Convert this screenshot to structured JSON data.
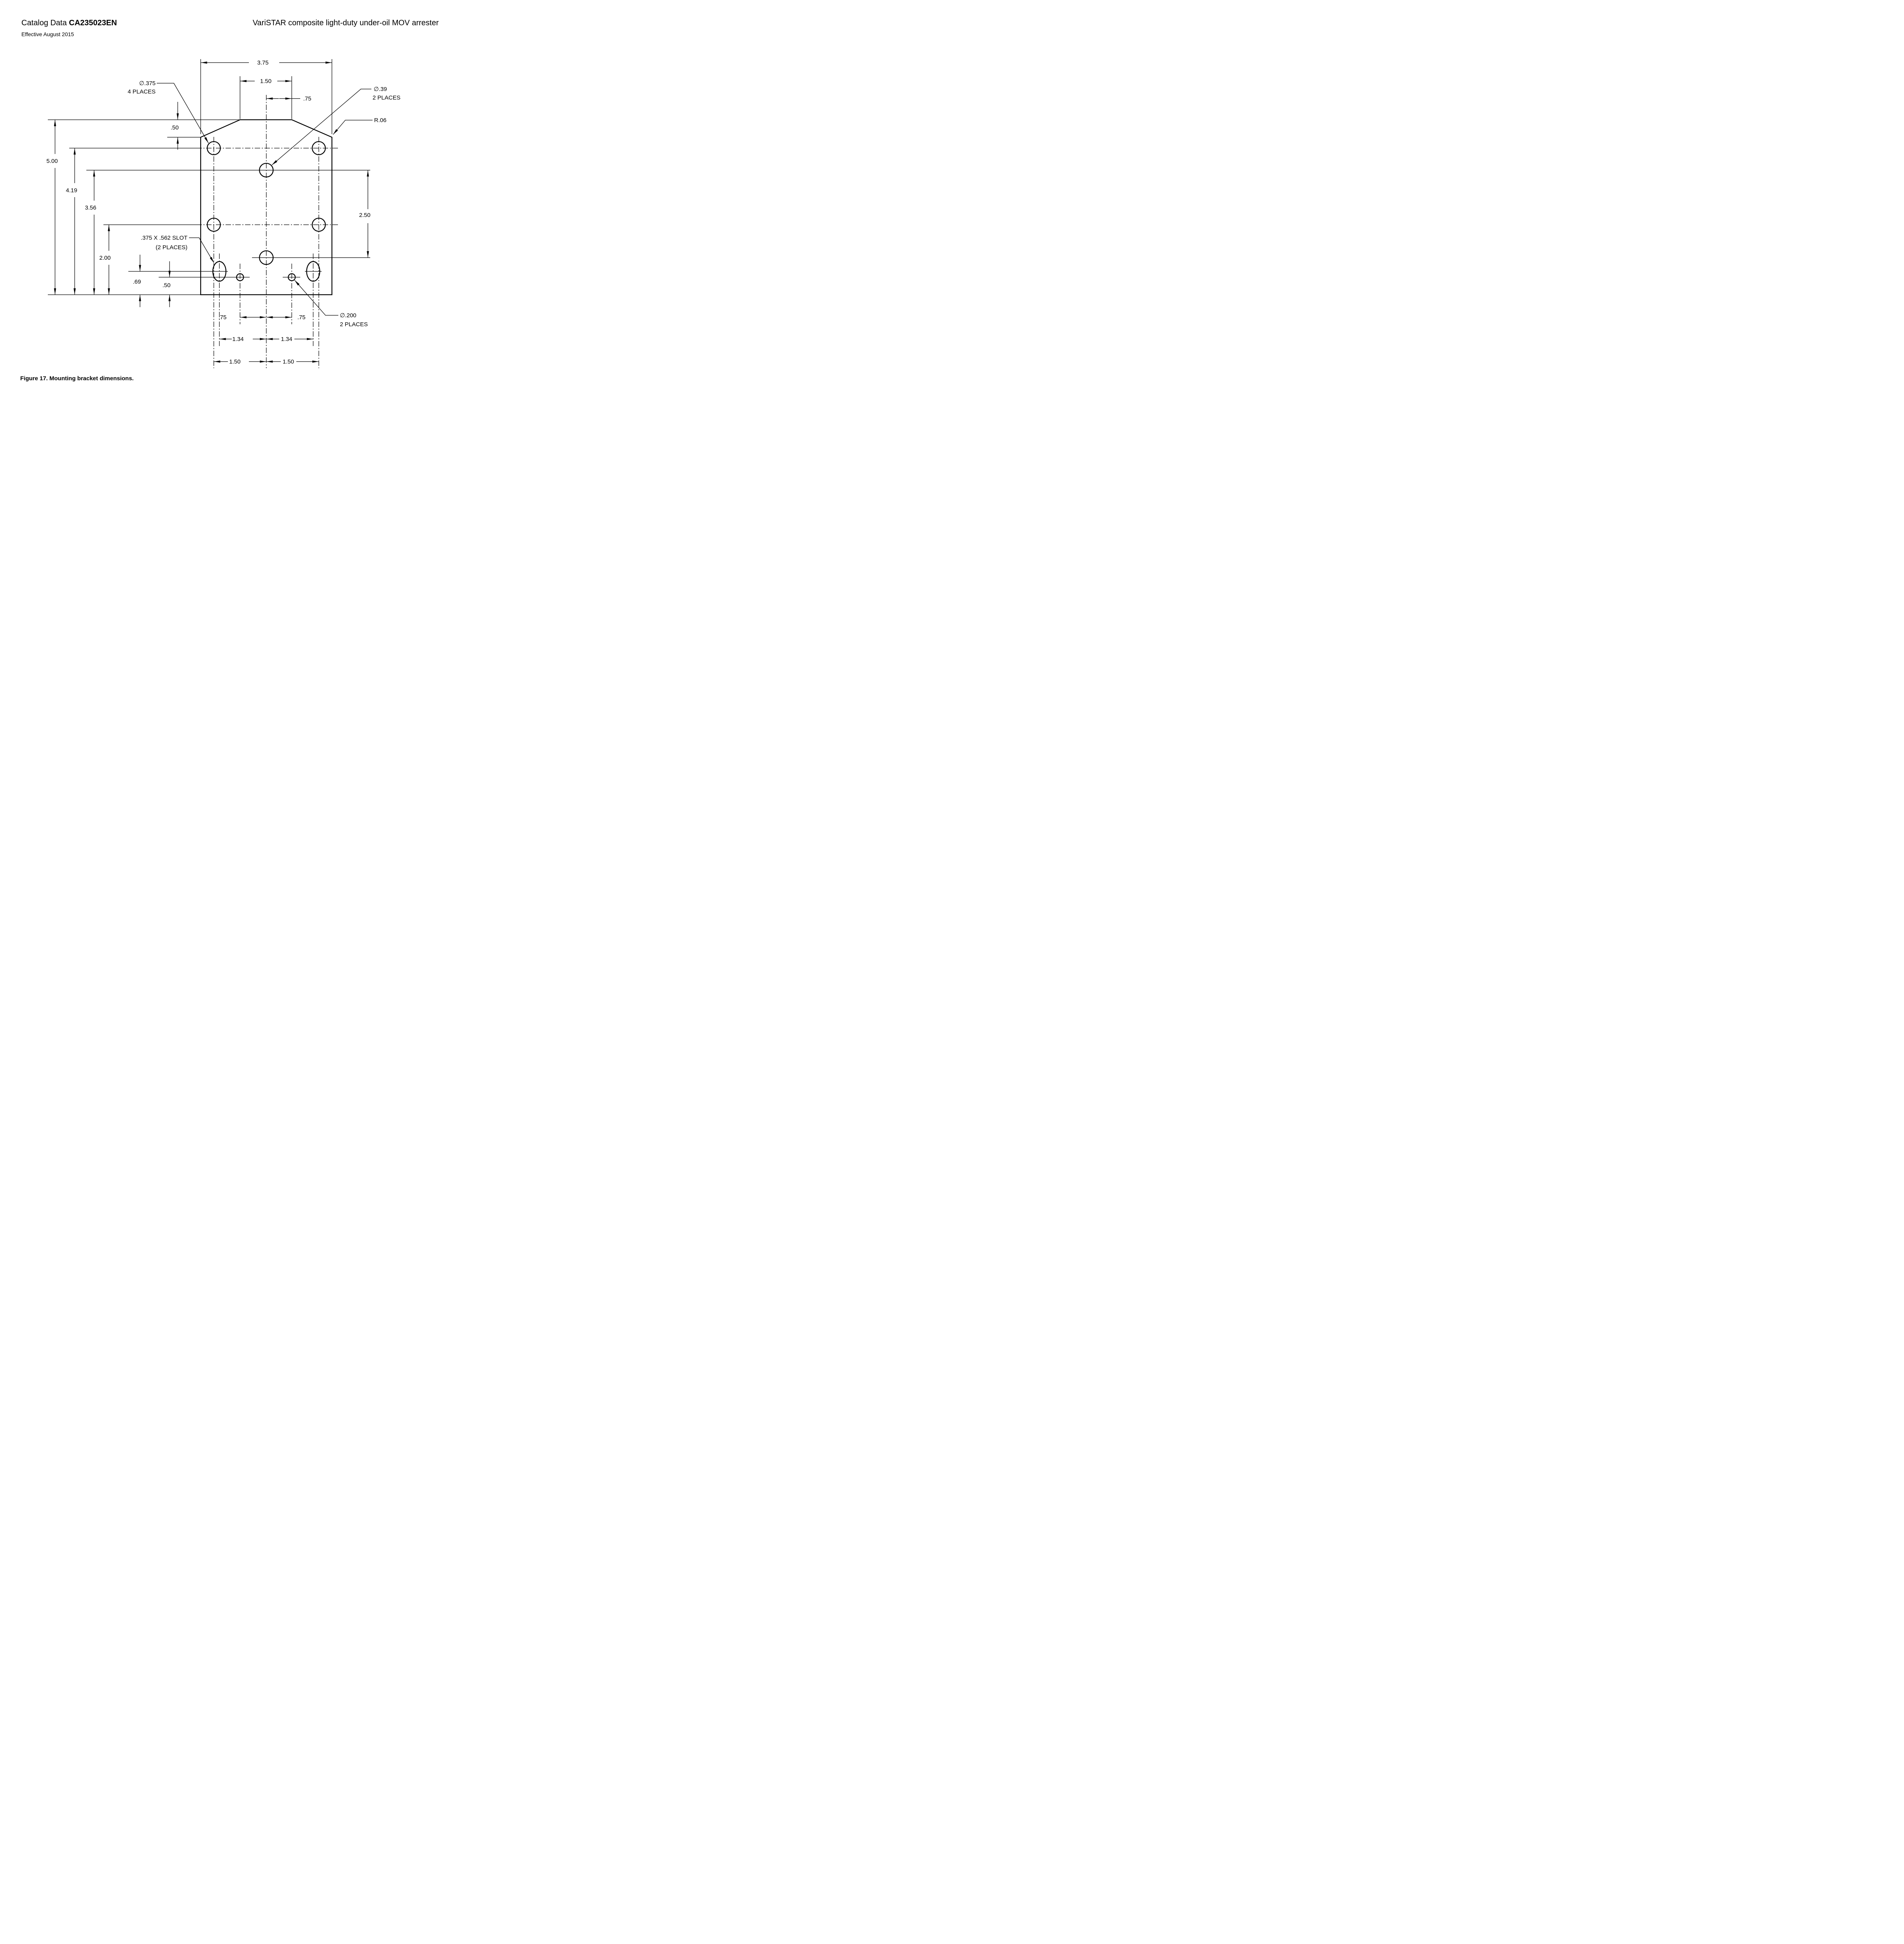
{
  "header": {
    "catalog_prefix": "Catalog Data ",
    "catalog_code": "CA235023EN",
    "effective_date": "Effective August 2015",
    "product_title": "VariSTAR composite light-duty under-oil MOV arrester"
  },
  "figure_caption": "Figure 17. Mounting bracket dimensions.",
  "drawing": {
    "dims": {
      "overall_width": "3.75",
      "flat_top_width": "1.50",
      "flat_top_half": ".75",
      "overall_height": "5.00",
      "upper_holes_from_bottom": "4.19",
      "center_hole_from_bottom": "3.56",
      "mid_holes_from_bottom": "2.00",
      "center_holes_spacing": "2.50",
      "chamfer_depth": ".50",
      "slot_center_from_bottom": ".69",
      "small_holes_from_bottom": ".50",
      "small_hole_offset_left": ".75",
      "small_hole_offset_right": ".75",
      "slot_offset_left": "1.34",
      "slot_offset_right": "1.34",
      "corner_holes_offset_left": "1.50",
      "corner_holes_offset_right": "1.50"
    },
    "callouts": {
      "corner_holes_dia": "∅.375",
      "corner_holes_places": "4 PLACES",
      "center_holes_dia": "∅.39",
      "center_holes_places": "2 PLACES",
      "corner_radius": "R.06",
      "slot_size": ".375 X .562 SLOT",
      "slot_places": "(2 PLACES)",
      "small_holes_dia": "∅.200",
      "small_holes_places": "2 PLACES"
    }
  }
}
